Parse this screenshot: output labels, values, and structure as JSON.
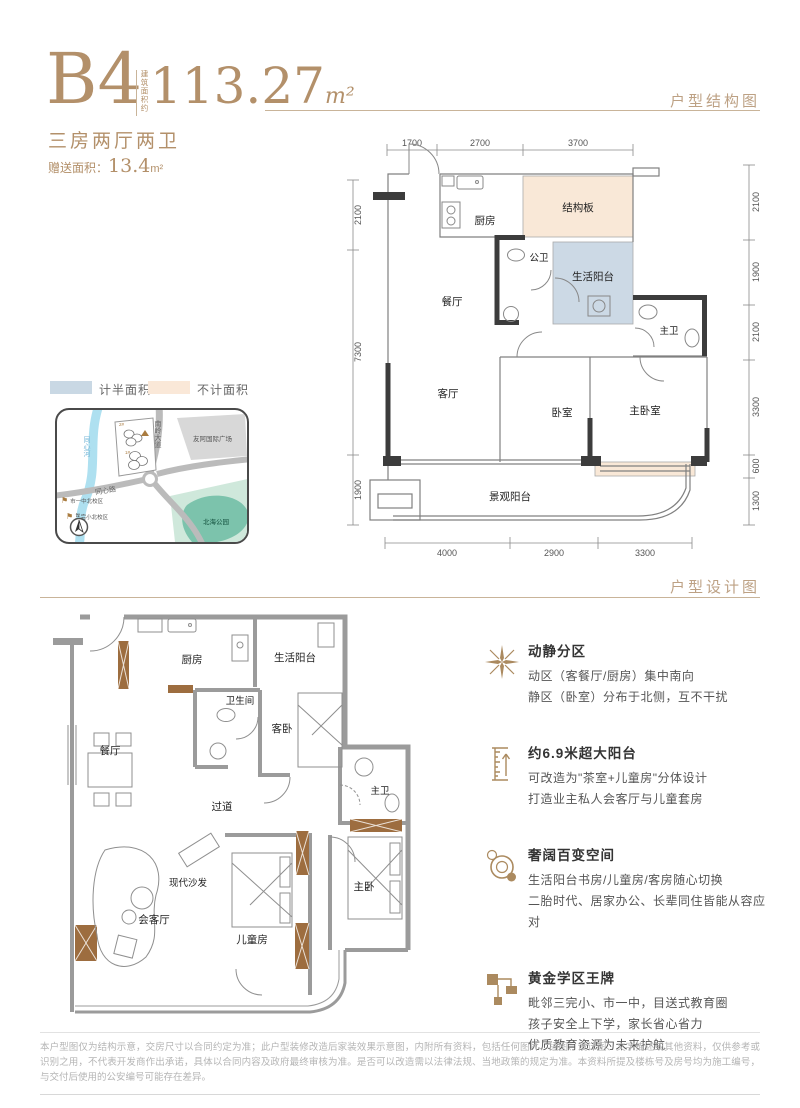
{
  "colors": {
    "accent": "#b3906a",
    "beige_fill": "#f9e8d7",
    "blue_fill": "#ccd9e5",
    "wall_dark": "#3c3c3c",
    "wall_gray": "#9b9b9b",
    "furniture_brown": "#9d6d3f"
  },
  "header": {
    "unit_name": "B4",
    "area_prefix_vertical": "建筑面积约",
    "area_value": "113.27",
    "area_unit": "m²",
    "layout_text": "三房两厅两卫",
    "bonus_label": "赠送面积：",
    "bonus_value": "13.4",
    "bonus_unit": "m²"
  },
  "sections": {
    "structure_title": "户型结构图",
    "design_title": "户型设计图"
  },
  "legend": {
    "half_area_label": "计半面积",
    "excluded_area_label": "不计面积"
  },
  "map": {
    "road_vertical": "南岭大道",
    "road_diagonal": "同心路",
    "river": "同心河",
    "mall": "友阿国际广场",
    "park": "北海公园",
    "school_1": "市一中北校区",
    "school_2": "三完小北校区",
    "plot_marker_1": "2#",
    "plot_marker_2": "1#",
    "compass": "N"
  },
  "structure_plan": {
    "rooms": {
      "kitchen": "厨房",
      "slab": "结构板",
      "public_bath": "公卫",
      "life_balcony": "生活阳台",
      "dining": "餐厅",
      "master_bath": "主卫",
      "living": "客厅",
      "bedroom": "卧室",
      "master_bedroom": "主卧室",
      "view_balcony": "景观阳台"
    },
    "dims_top": [
      "1700",
      "2700",
      "3700"
    ],
    "dims_bottom": [
      "4000",
      "2900",
      "3300"
    ],
    "dims_left": [
      "2100",
      "7300",
      "1900"
    ],
    "dims_right": [
      "2100",
      "1900",
      "2100",
      "3300",
      "600",
      "1300"
    ]
  },
  "design_plan": {
    "rooms": {
      "kitchen": "厨房",
      "life_balcony": "生活阳台",
      "bath": "卫生间",
      "guest_bed": "客卧",
      "dining": "餐厅",
      "corridor": "过道",
      "master_bath": "主卫",
      "sofa": "现代沙发",
      "reception": "会客厅",
      "kids_room": "儿童房",
      "master_bed": "主卧"
    }
  },
  "features": [
    {
      "title": "动静分区",
      "lines": [
        "动区（客餐厅/厨房）集中南向",
        "静区（卧室）分布于北侧，互不干扰"
      ]
    },
    {
      "title": "约6.9米超大阳台",
      "lines": [
        "可改造为\"茶室+儿童房\"分体设计",
        "打造业主私人会客厅与儿童套房"
      ]
    },
    {
      "title": "奢阔百变空间",
      "lines": [
        "生活阳台书房/儿童房/客房随心切换",
        "二胎时代、居家办公、长辈同住皆能从容应对"
      ]
    },
    {
      "title": "黄金学区王牌",
      "lines": [
        "毗邻三完小、市一中，目送式教育圈",
        "孩子安全上下学，家长省心省力",
        "优质教育资源为未来护航"
      ]
    }
  ],
  "disclaimer": "本户型图仅为结构示意，交房尺寸以合同约定为准；此户型装修改造后家装效果示意图，内附所有资料，包括任何图片、插图、设计图、文字描述或其他资料，仅供参考或识别之用，不代表开发商作出承诺，具体以合同内容及政府最终审核为准。是否可以改造需以法律法规、当地政策的规定为准。本资料所提及楼栋号及房号均为施工编号，与交付后使用的公安编号可能存在差异。"
}
